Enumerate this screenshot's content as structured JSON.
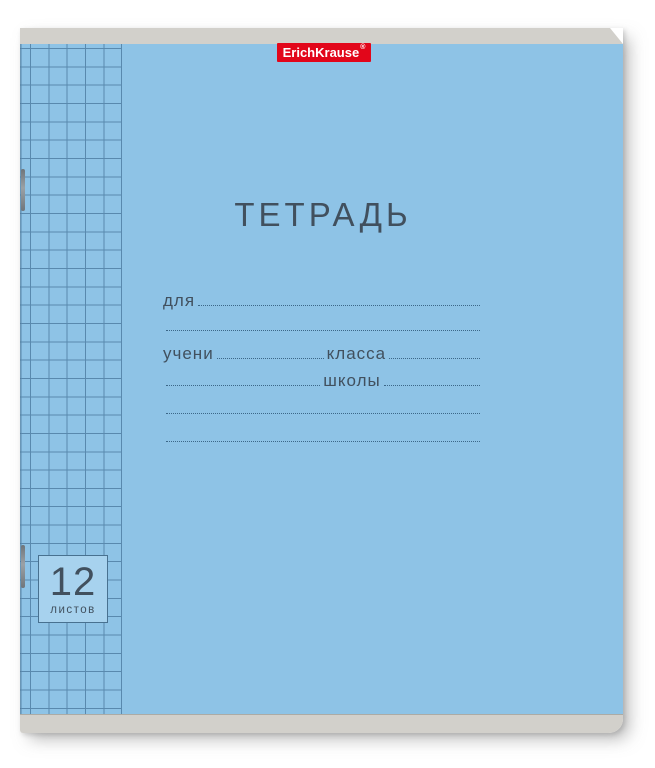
{
  "notebook": {
    "brand": {
      "name": "ErichKrause",
      "registered": "®"
    },
    "title": "ТЕТРАДЬ",
    "form": {
      "for_label": "для",
      "student_label": "учени",
      "class_label": "класса",
      "school_label": "школы"
    },
    "sheets": {
      "count": "12",
      "unit": "листов"
    },
    "colors": {
      "cover": "#8ec3e6",
      "grid_line": "#2e5a82",
      "binding": "#d2d0cb",
      "brand_red": "#e2061a",
      "ink": "#41505e",
      "box_fill": "#a7d2ee"
    }
  }
}
